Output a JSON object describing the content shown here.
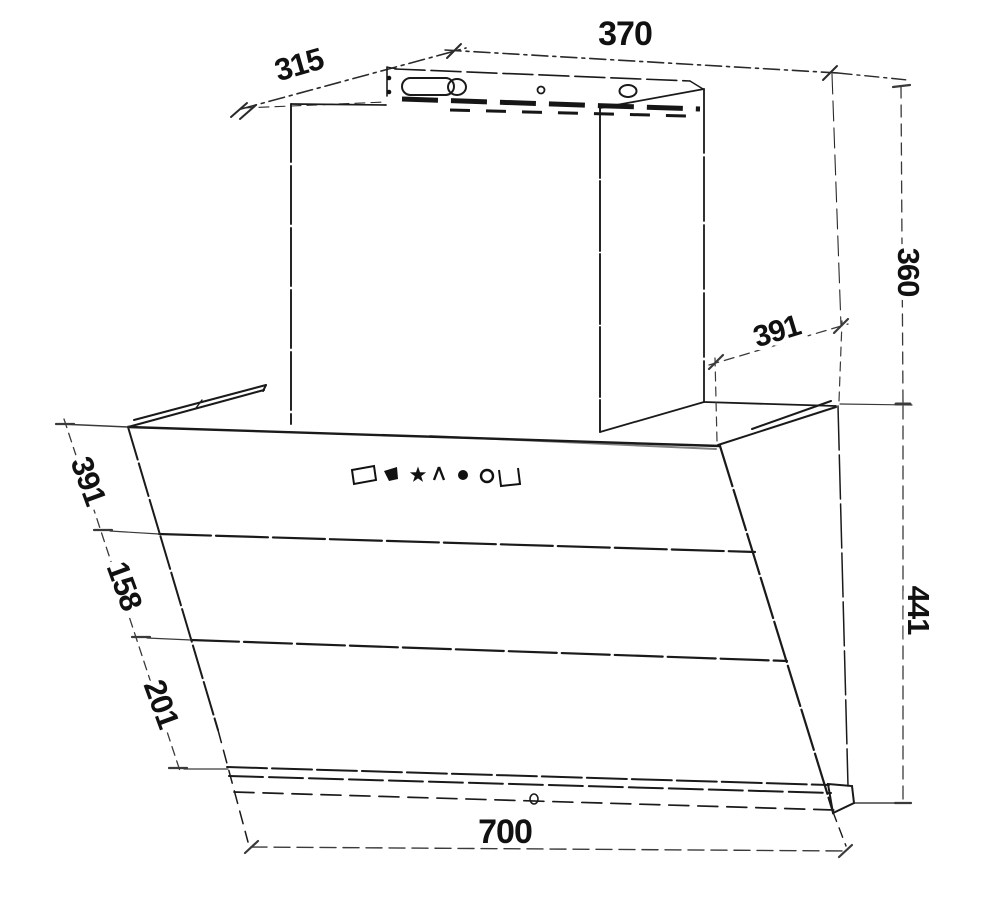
{
  "drawing": {
    "kind": "technical dimension drawing of an angled wall-mounted cooker hood",
    "background_color": "#ffffff",
    "line_color": "#1a1a1a",
    "dimension_color": "#3a3a3a"
  },
  "dimensions": {
    "top_width": "370",
    "top_depth": "315",
    "chimney_height": "360",
    "top_rear_depth": "391",
    "glass_top_section": "391",
    "glass_middle_section": "158",
    "glass_bottom_section": "201",
    "body_height": "441",
    "body_width": "700"
  },
  "control_icons": [
    "display-window-icon",
    "fan-wing-icon",
    "star-icon",
    "delay-person-icon",
    "power-dot-icon",
    "lamp-circle-icon",
    "open-tray-icon"
  ]
}
